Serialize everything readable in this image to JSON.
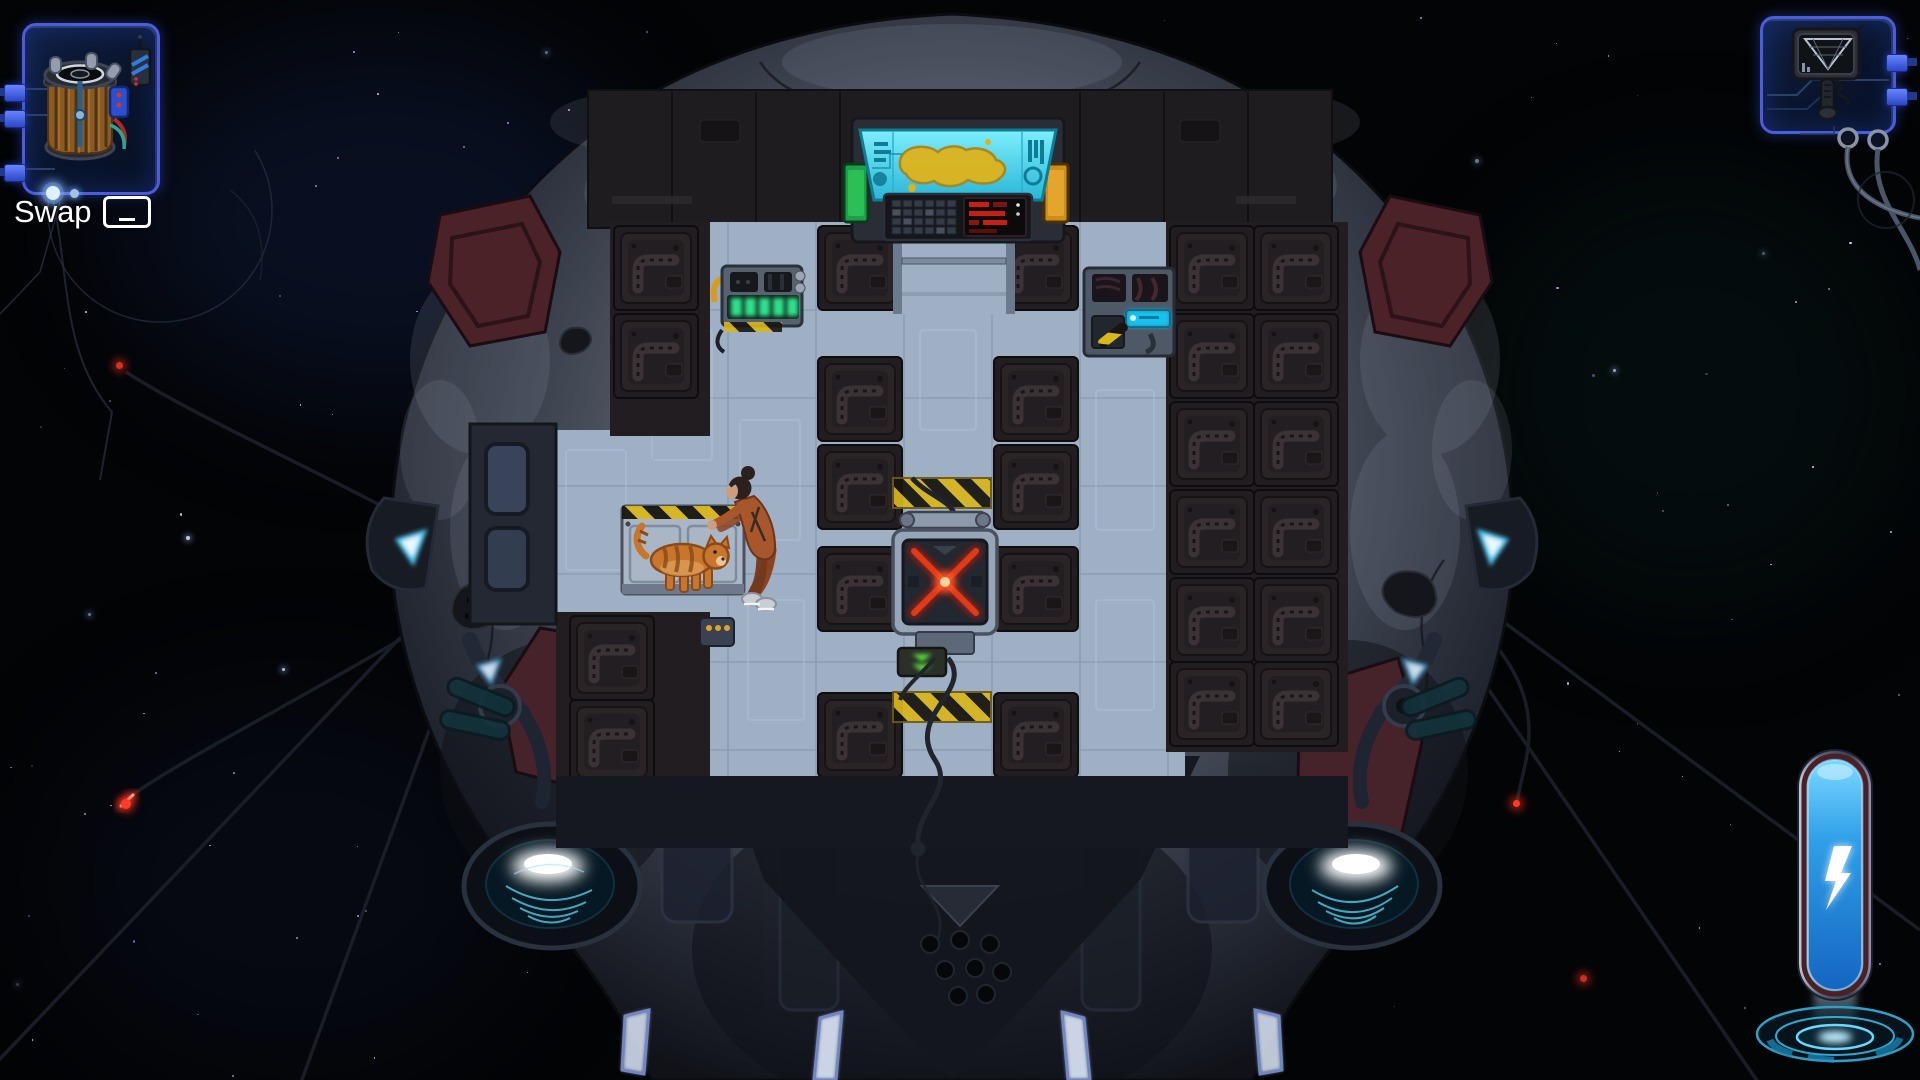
{
  "hud": {
    "swap_hint": {
      "label": "Swap",
      "key": "spacebar",
      "key_icon": "spacebar-key-icon"
    },
    "item_slots": {
      "left": {
        "item": "portable-power-generator",
        "frame_color": "#4a5ce0"
      },
      "right": {
        "item": "handheld-salvage-scanner",
        "frame_color": "#4a5ce0"
      }
    },
    "energy_gauge": {
      "icon": "lightning-bolt-icon",
      "state": "full",
      "tube_color": "#2f9fe8",
      "base_style": "holographic-rings"
    }
  },
  "scene": {
    "setting": "top-down asteroid salvage ship floating in space",
    "room": {
      "floor_color": "#9fb0c5",
      "wall_color": "#221d20",
      "hazard_stripe_colors": [
        "#d8b61c",
        "#17150f"
      ],
      "objects": [
        {
          "name": "map-console",
          "screen_color": "#4fd9ef",
          "map_blob_color": "#dcb41e",
          "side_panels": [
            "green",
            "orange"
          ]
        },
        {
          "name": "battery-charger",
          "cells": 5,
          "cell_color": "#2ee08a"
        },
        {
          "name": "wire-terminal",
          "display_color": "#19c2f0"
        },
        {
          "name": "locked-hatch",
          "x_color": "#d42a12"
        },
        {
          "name": "eject-port",
          "arrow_color": "#58d63a"
        },
        {
          "name": "supply-crate"
        },
        {
          "name": "cat",
          "description": "orange tabby standing on crate",
          "fur_color": "#c8762e"
        },
        {
          "name": "crew-member",
          "description": "woman in rust jumpsuit bending to pet the cat",
          "suit_color": "#a8562b"
        }
      ]
    },
    "ship": {
      "hull": "grey rocky asteroid shell",
      "armor_color": "#4a2228",
      "led_panel_dot_color": "#5d7cf2",
      "engine_glow_color": "#bfeaff",
      "marker_light_color": "#7fd4f2",
      "tether_count": 6,
      "tether_tip_color": "#ff3522"
    },
    "space": {
      "background": "#030406",
      "star_colors": [
        "#dfe8ff",
        "#aab8ff",
        "#d8ccff"
      ],
      "red_signal_lights": 4
    }
  }
}
